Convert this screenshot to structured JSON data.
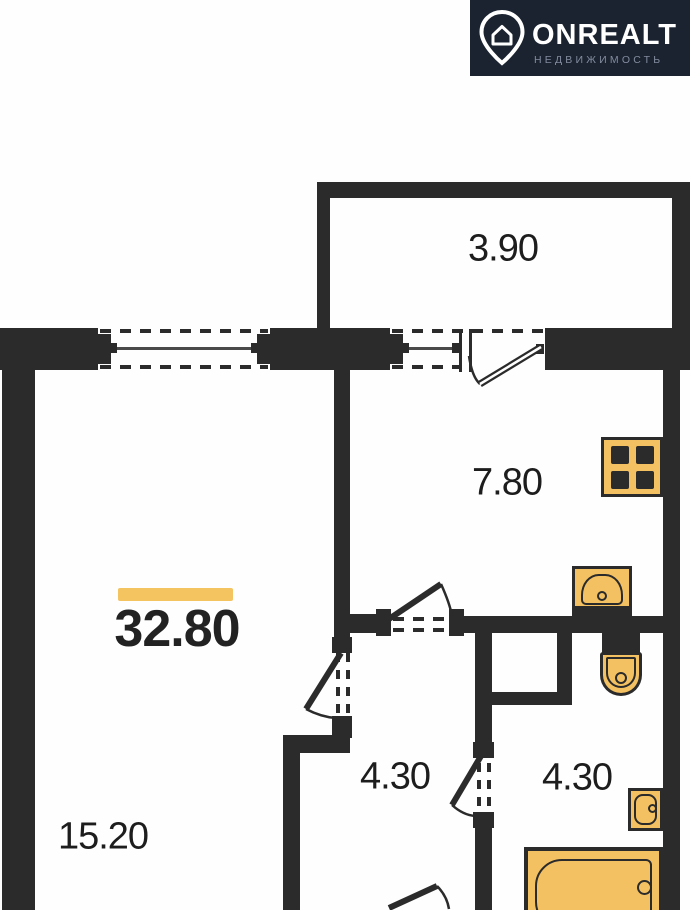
{
  "logo": {
    "brand": "ONREALT",
    "tagline": "НЕДВИЖИМОСТЬ"
  },
  "plan": {
    "total_area_label": "32.80",
    "rooms": [
      {
        "name": "balcony",
        "area_label": "3.90"
      },
      {
        "name": "kitchen",
        "area_label": "7.80"
      },
      {
        "name": "hallway",
        "area_label": "4.30"
      },
      {
        "name": "bathroom",
        "area_label": "4.30"
      },
      {
        "name": "living-room",
        "area_label": "15.20"
      }
    ]
  },
  "colors": {
    "wall": "#2b2b2b",
    "fixture_fill": "#f4c162",
    "highlight_bar": "#f3c45f",
    "logo_background": "#1b2330",
    "logo_text": "#ffffff",
    "logo_tagline": "#828c9e",
    "label_text": "#1d1d1d"
  }
}
